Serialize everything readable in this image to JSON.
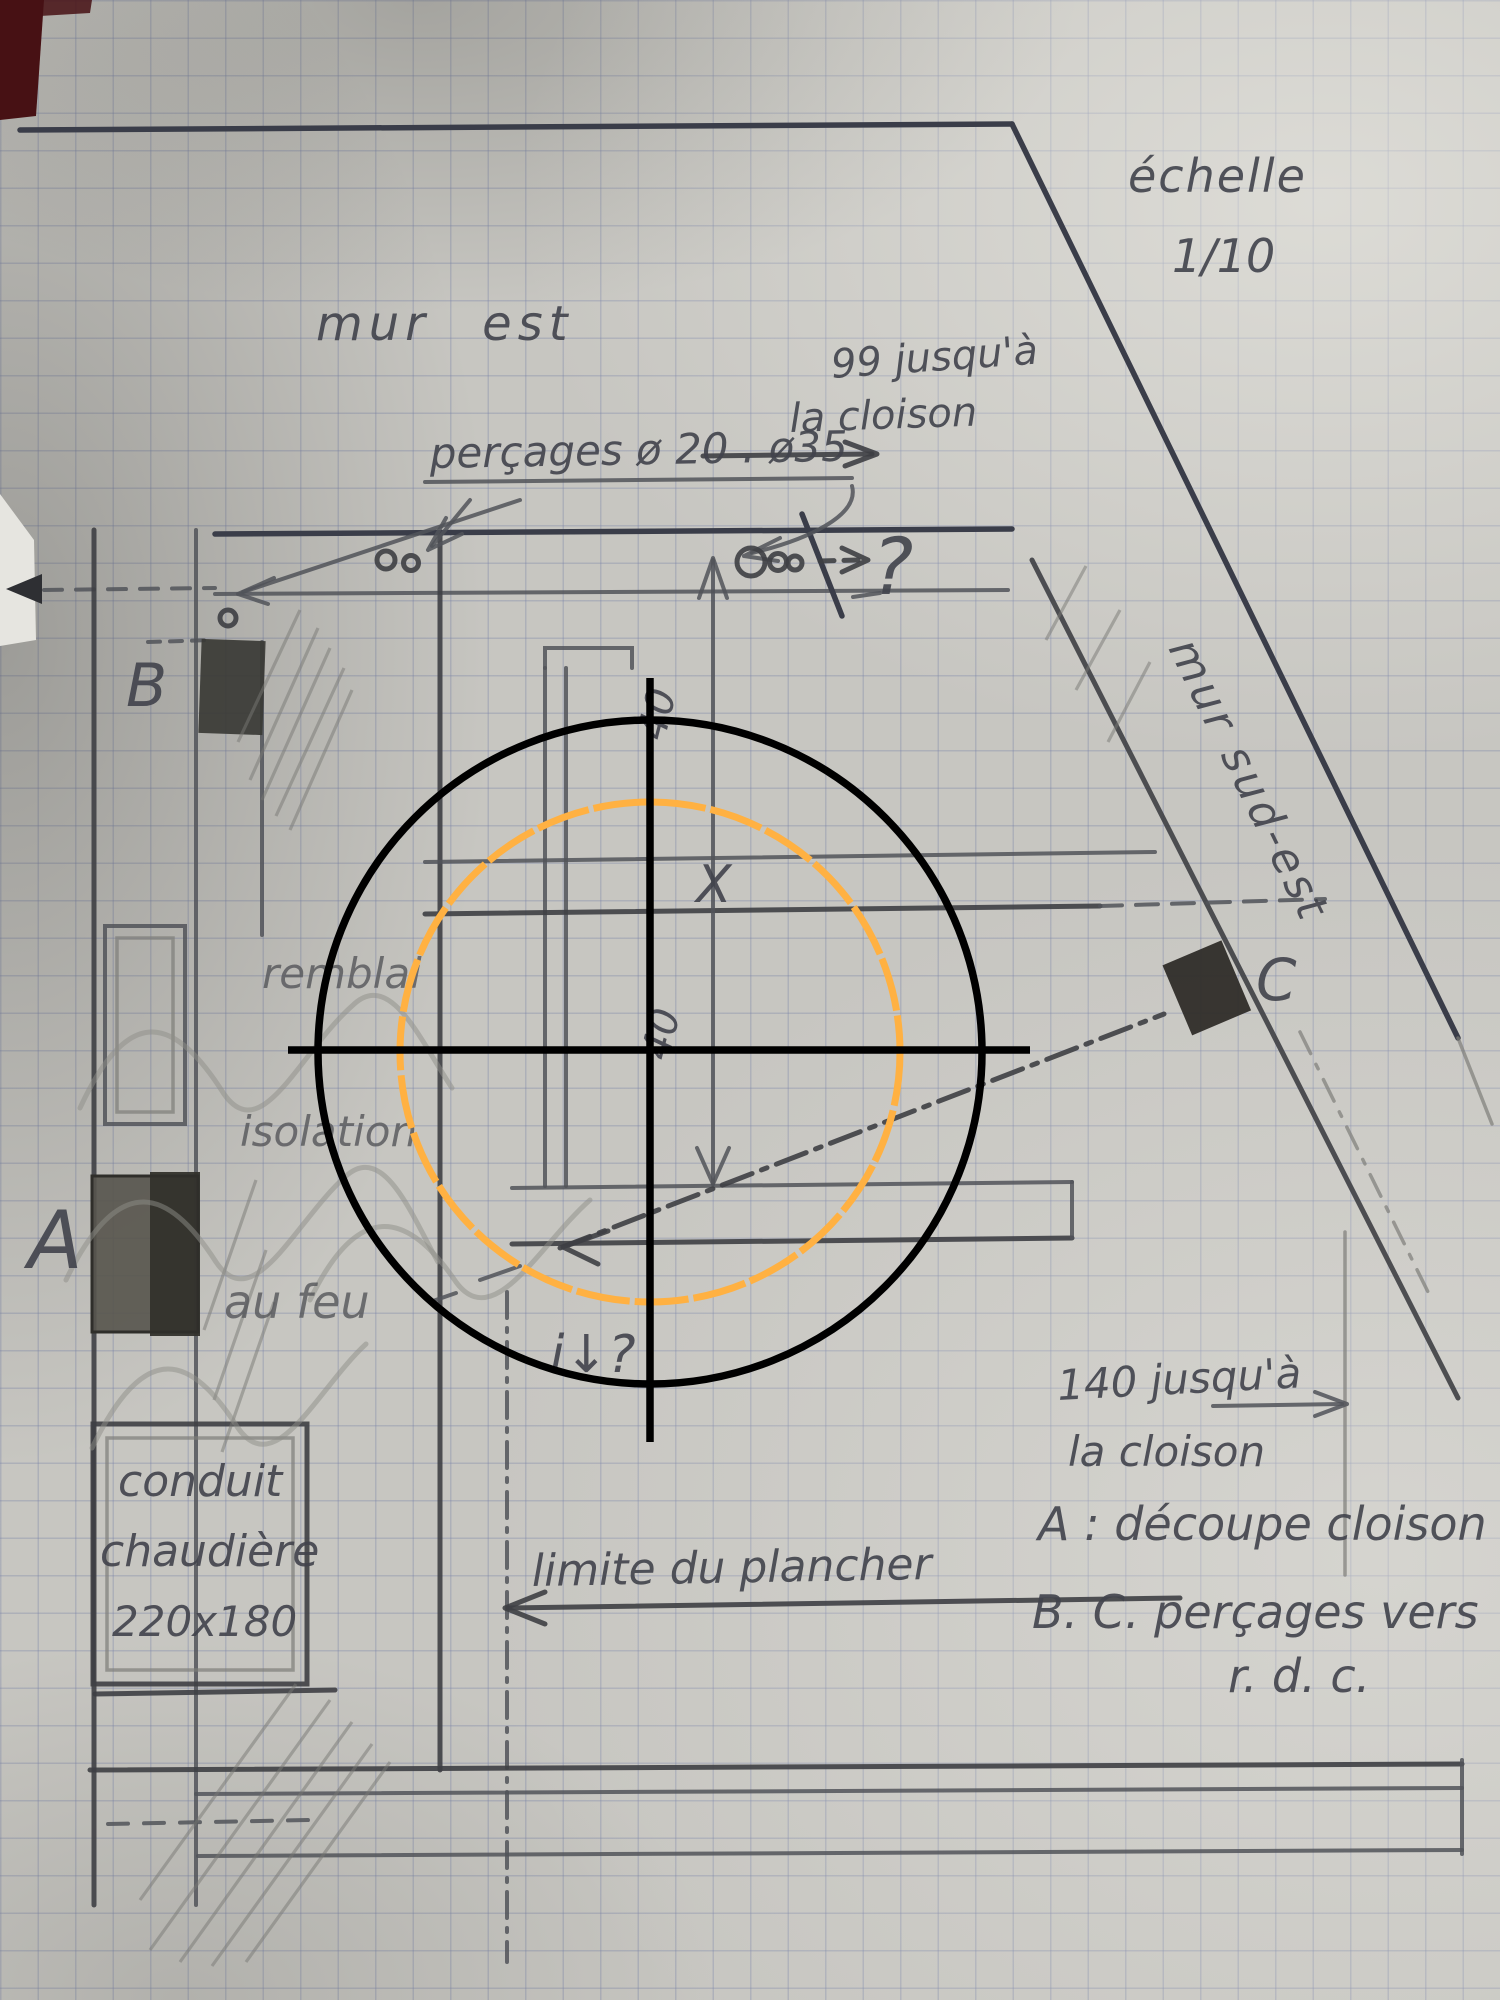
{
  "photo_of": "hand-drawn construction plan sketch on graph paper",
  "scale": {
    "label": "échelle",
    "value": "1/10"
  },
  "walls": {
    "east_label": "mur est",
    "southeast_label": "mur sud-est"
  },
  "notes": {
    "drillings": "perçages ø 20 . ø35",
    "dist_top_1": "99 jusqu'à",
    "dist_top_2": "la cloison",
    "dist_bottom_1": "140 jusqu'à",
    "dist_bottom_2": "la cloison",
    "floor_limit": "limite du plancher",
    "question_top": "?",
    "question_bottom": "i↓?"
  },
  "measures": {
    "forty_upper": "40",
    "forty_lower": "40"
  },
  "points": {
    "a": "A",
    "b": "B",
    "c": "C",
    "x_mark": "X"
  },
  "areas": {
    "backfill": "remblai",
    "insulation": "isolation",
    "fire": "au feu"
  },
  "conduit": {
    "line1": "conduit",
    "line2": "chaudière",
    "size": "220x180"
  },
  "legend": {
    "a_line": "A : découpe cloison",
    "bc_line": "B. C. perçages vers",
    "bc_line2": "r. d. c."
  },
  "overlay": {
    "crosshair_color": "#000000",
    "ring_color": "#ffb142"
  }
}
